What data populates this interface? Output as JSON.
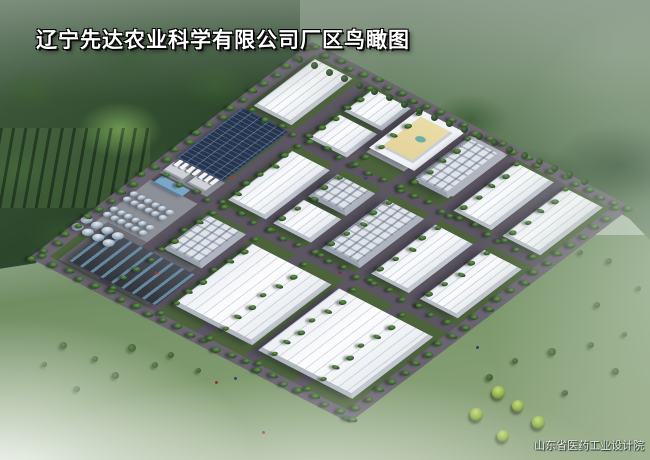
{
  "title": {
    "text": "辽宁先达农业科学有限公司厂区鸟瞰图"
  },
  "credit": {
    "text": "山东省医药工业设计院"
  },
  "palette": {
    "road": "#5c5662",
    "road_perimeter": "#6a6370",
    "site_grass": "#4c633c",
    "roof_white": "#f5f7f9",
    "facade_grey": "#c2c7d0",
    "solar_blue": "#26354f",
    "tank_steel": "#9db0c1",
    "courtyard_yellow": "#e9dca6",
    "plant_dark": "#383c44",
    "forest_green": "#2c462b",
    "haze_white": "#fafcfa",
    "bright_tree": "#9dbb4e"
  },
  "scene": {
    "site": {
      "origin_x": 312,
      "origin_y": 42,
      "width": 340,
      "height": 370,
      "matrix": [
        0.941,
        0.485,
        -0.764,
        0.583
      ]
    },
    "pads": [
      [
        8,
        190,
        54,
        118,
        "apron"
      ],
      [
        20,
        292,
        106,
        64,
        "apron-dark"
      ],
      [
        118,
        6,
        100,
        78,
        "apron-light"
      ]
    ],
    "roads": [
      [
        0,
        0,
        340,
        12,
        "per"
      ],
      [
        0,
        0,
        12,
        370,
        "per"
      ],
      [
        328,
        0,
        12,
        370,
        "per"
      ],
      [
        0,
        358,
        340,
        12,
        "per"
      ],
      [
        62,
        12,
        12,
        346,
        ""
      ],
      [
        114,
        12,
        12,
        346,
        ""
      ],
      [
        166,
        12,
        12,
        346,
        ""
      ],
      [
        218,
        12,
        12,
        346,
        ""
      ],
      [
        270,
        12,
        12,
        346,
        ""
      ],
      [
        12,
        102,
        316,
        12,
        ""
      ],
      [
        12,
        214,
        316,
        12,
        ""
      ]
    ],
    "buildings": [
      [
        "wh",
        16,
        16,
        40,
        80
      ],
      [
        "so",
        10,
        104,
        50,
        86
      ],
      [
        "sh",
        12,
        196,
        20,
        14
      ],
      [
        "sh",
        38,
        198,
        18,
        12
      ],
      [
        "shb",
        16,
        216,
        30,
        12
      ],
      [
        "wh",
        78,
        16,
        40,
        38
      ],
      [
        "wh",
        78,
        60,
        40,
        40
      ],
      [
        "of",
        124,
        12,
        48,
        66
      ],
      [
        "ms",
        180,
        16,
        36,
        72
      ],
      [
        "wh",
        230,
        16,
        40,
        82
      ],
      [
        "wh",
        282,
        16,
        40,
        82
      ],
      [
        "wh",
        78,
        122,
        40,
        84
      ],
      [
        "ms",
        126,
        122,
        40,
        38
      ],
      [
        "wh",
        126,
        166,
        40,
        40
      ],
      [
        "ms",
        178,
        122,
        40,
        84
      ],
      [
        "wh",
        230,
        122,
        40,
        84
      ],
      [
        "wh",
        282,
        122,
        40,
        84
      ],
      [
        "ms",
        78,
        232,
        40,
        58
      ],
      [
        "whl",
        130,
        238,
        84,
        104
      ],
      [
        "whl",
        222,
        238,
        100,
        106
      ],
      [
        "pl",
        28,
        300,
        92,
        52
      ]
    ],
    "tank_groups": [
      [
        10,
        246,
        6,
        2,
        7,
        7.6,
        9
      ],
      [
        10,
        272,
        6,
        2,
        7,
        7.6,
        9
      ],
      [
        0,
        296,
        4,
        2,
        10,
        11,
        12
      ]
    ],
    "tree_lines": [
      [
        4,
        2,
        "h",
        332,
        26,
        6
      ],
      [
        1,
        6,
        "v",
        360,
        26,
        6
      ],
      [
        330,
        6,
        "v",
        358,
        24,
        6
      ],
      [
        4,
        360,
        "h",
        332,
        24,
        6
      ],
      [
        75,
        14,
        "v",
        340,
        22,
        5
      ],
      [
        127,
        14,
        "v",
        340,
        20,
        5
      ],
      [
        179,
        14,
        "v",
        340,
        20,
        5
      ],
      [
        231,
        14,
        "v",
        340,
        20,
        5
      ],
      [
        283,
        14,
        "v",
        340,
        20,
        5
      ],
      [
        16,
        100,
        "h",
        300,
        20,
        5
      ],
      [
        16,
        212,
        "h",
        300,
        20,
        5
      ]
    ],
    "vehicles": {
      "x0": 14,
      "y0": 190,
      "dx": 6.4,
      "n": 7,
      "w": 4,
      "h": 9
    },
    "figures": [
      [
        92,
        317,
        "#b53229"
      ],
      [
        146,
        110,
        "#31427f"
      ],
      [
        208,
        220,
        "#7c2f2f"
      ],
      [
        60,
        180,
        "#b53229"
      ]
    ]
  },
  "outside": {
    "avenue_trees": {
      "x0": 296,
      "y0": 56,
      "dx": 15,
      "dy": 6.4,
      "n": 20,
      "s": 7
    },
    "bushes": [
      [
        60,
        342,
        7
      ],
      [
        92,
        356,
        6
      ],
      [
        128,
        344,
        8
      ],
      [
        74,
        386,
        6
      ],
      [
        112,
        372,
        7
      ],
      [
        152,
        362,
        6
      ],
      [
        42,
        362,
        5
      ],
      [
        168,
        352,
        6
      ],
      [
        196,
        368,
        5
      ],
      [
        486,
        374,
        7
      ],
      [
        512,
        358,
        6
      ],
      [
        548,
        348,
        8
      ],
      [
        588,
        342,
        6
      ],
      [
        612,
        368,
        7
      ],
      [
        562,
        390,
        6
      ],
      [
        622,
        332,
        5
      ],
      [
        594,
        302,
        6
      ],
      [
        636,
        286,
        5
      ],
      [
        606,
        258,
        6
      ],
      [
        578,
        250,
        5
      ]
    ],
    "bright_trees": [
      [
        492,
        386,
        13
      ],
      [
        470,
        408,
        13
      ],
      [
        512,
        400,
        12
      ],
      [
        532,
        416,
        13
      ],
      [
        497,
        430,
        12
      ]
    ],
    "figures": [
      [
        215,
        381,
        "#8c3030"
      ],
      [
        234,
        377,
        "#2f3f73"
      ],
      [
        262,
        431,
        "#8c3030"
      ],
      [
        476,
        346,
        "#2f3f73"
      ]
    ]
  }
}
